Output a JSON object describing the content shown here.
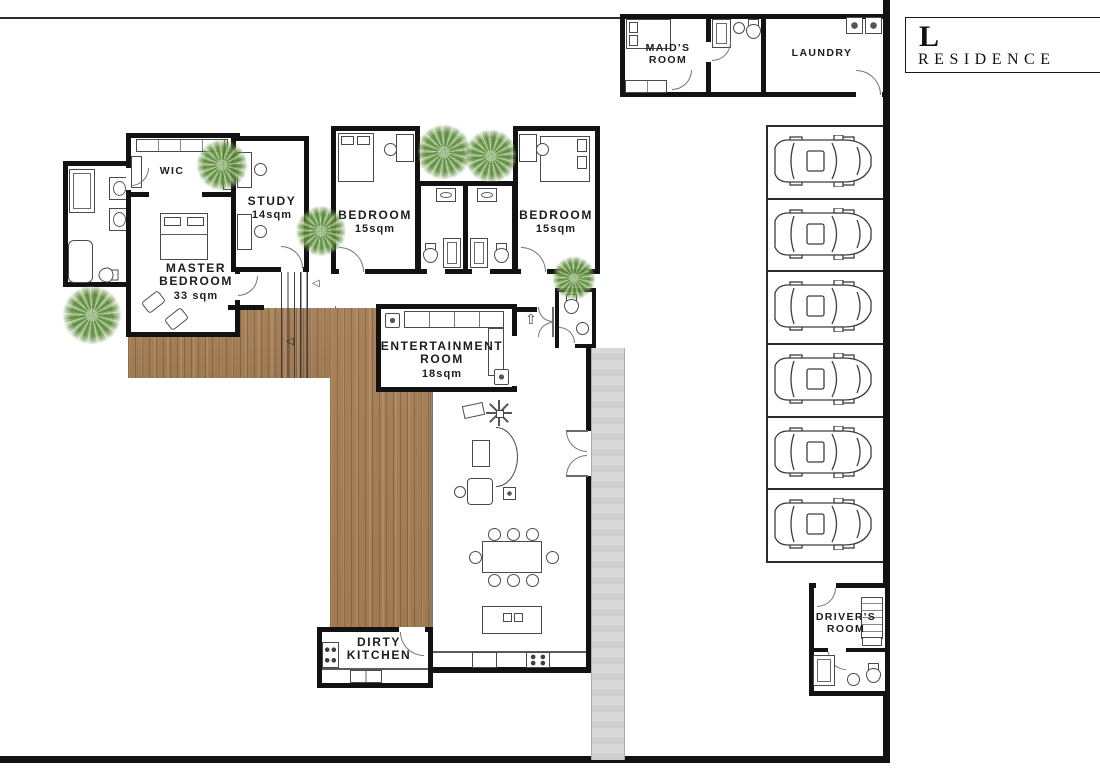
{
  "logo": {
    "letter": "L",
    "name": "RESIDENCE"
  },
  "rooms": {
    "maids_room": {
      "line1": "MAID'S",
      "line2": "ROOM"
    },
    "laundry": {
      "label": "LAUNDRY"
    },
    "wic": {
      "label": "WIC"
    },
    "study": {
      "label": "STUDY",
      "area": "14sqm"
    },
    "bedroom_left": {
      "label": "BEDROOM",
      "area": "15sqm"
    },
    "bedroom_right": {
      "label": "BEDROOM",
      "area": "15sqm"
    },
    "master_bedroom": {
      "line1": "MASTER",
      "line2": "BEDROOM",
      "area": "33 sqm"
    },
    "entertainment": {
      "line1": "ENTERTAINMENT",
      "line2": "ROOM",
      "area": "18sqm"
    },
    "dirty_kitchen": {
      "line1": "DIRTY",
      "line2": "KITCHEN"
    },
    "drivers_room": {
      "line1": "DRIVER'S",
      "line2": "ROOM"
    }
  },
  "garage": {
    "car_count": 6
  },
  "arrows": {
    "deck_arrow": "◁",
    "corridor_arrow": "◁",
    "entry_arrow": "⇧"
  },
  "colors": {
    "wall": "#121212",
    "deck_wood": "#a8825b",
    "walkway": "#d9d9d9",
    "foliage": "#86ae64",
    "background": "#ffffff"
  }
}
